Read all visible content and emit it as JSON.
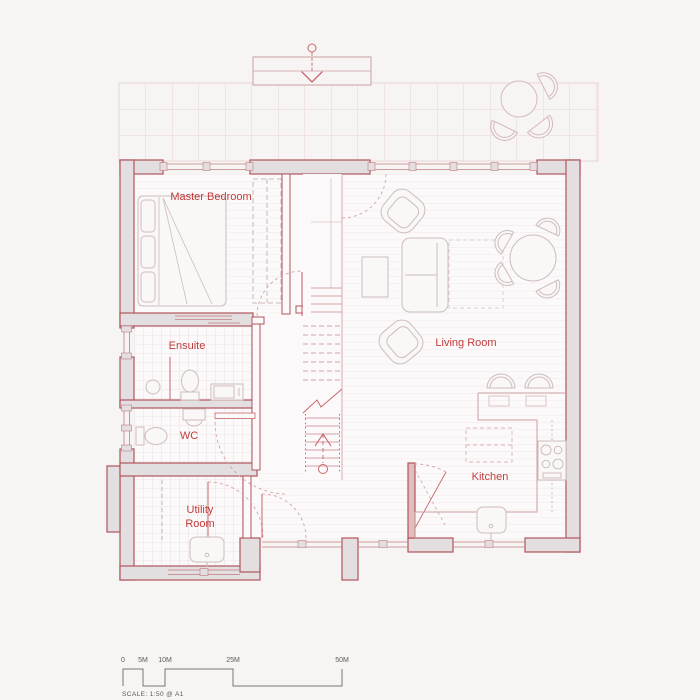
{
  "plan": {
    "rooms": {
      "master_bedroom": "Master Bedroom",
      "ensuite": "Ensuite",
      "wc": "WC",
      "utility_line1": "Utility",
      "utility_line2": "Room",
      "living_room": "Living Room",
      "kitchen": "Kitchen"
    },
    "scale_bar": {
      "tick_0": "0",
      "tick_5": "5M",
      "tick_10": "10M",
      "tick_25": "25M",
      "tick_50": "50M",
      "caption": "SCALE:  1:50 @ A1"
    },
    "colors": {
      "background": "#f7f5f4",
      "wall_fill": "#e3dfe0",
      "wall_stroke": "#b0545b",
      "label_red": "#c23c3c",
      "thin_red": "#c9666c",
      "light_red": "#d6a3a6",
      "furniture_stroke": "#cfbdbd"
    }
  }
}
